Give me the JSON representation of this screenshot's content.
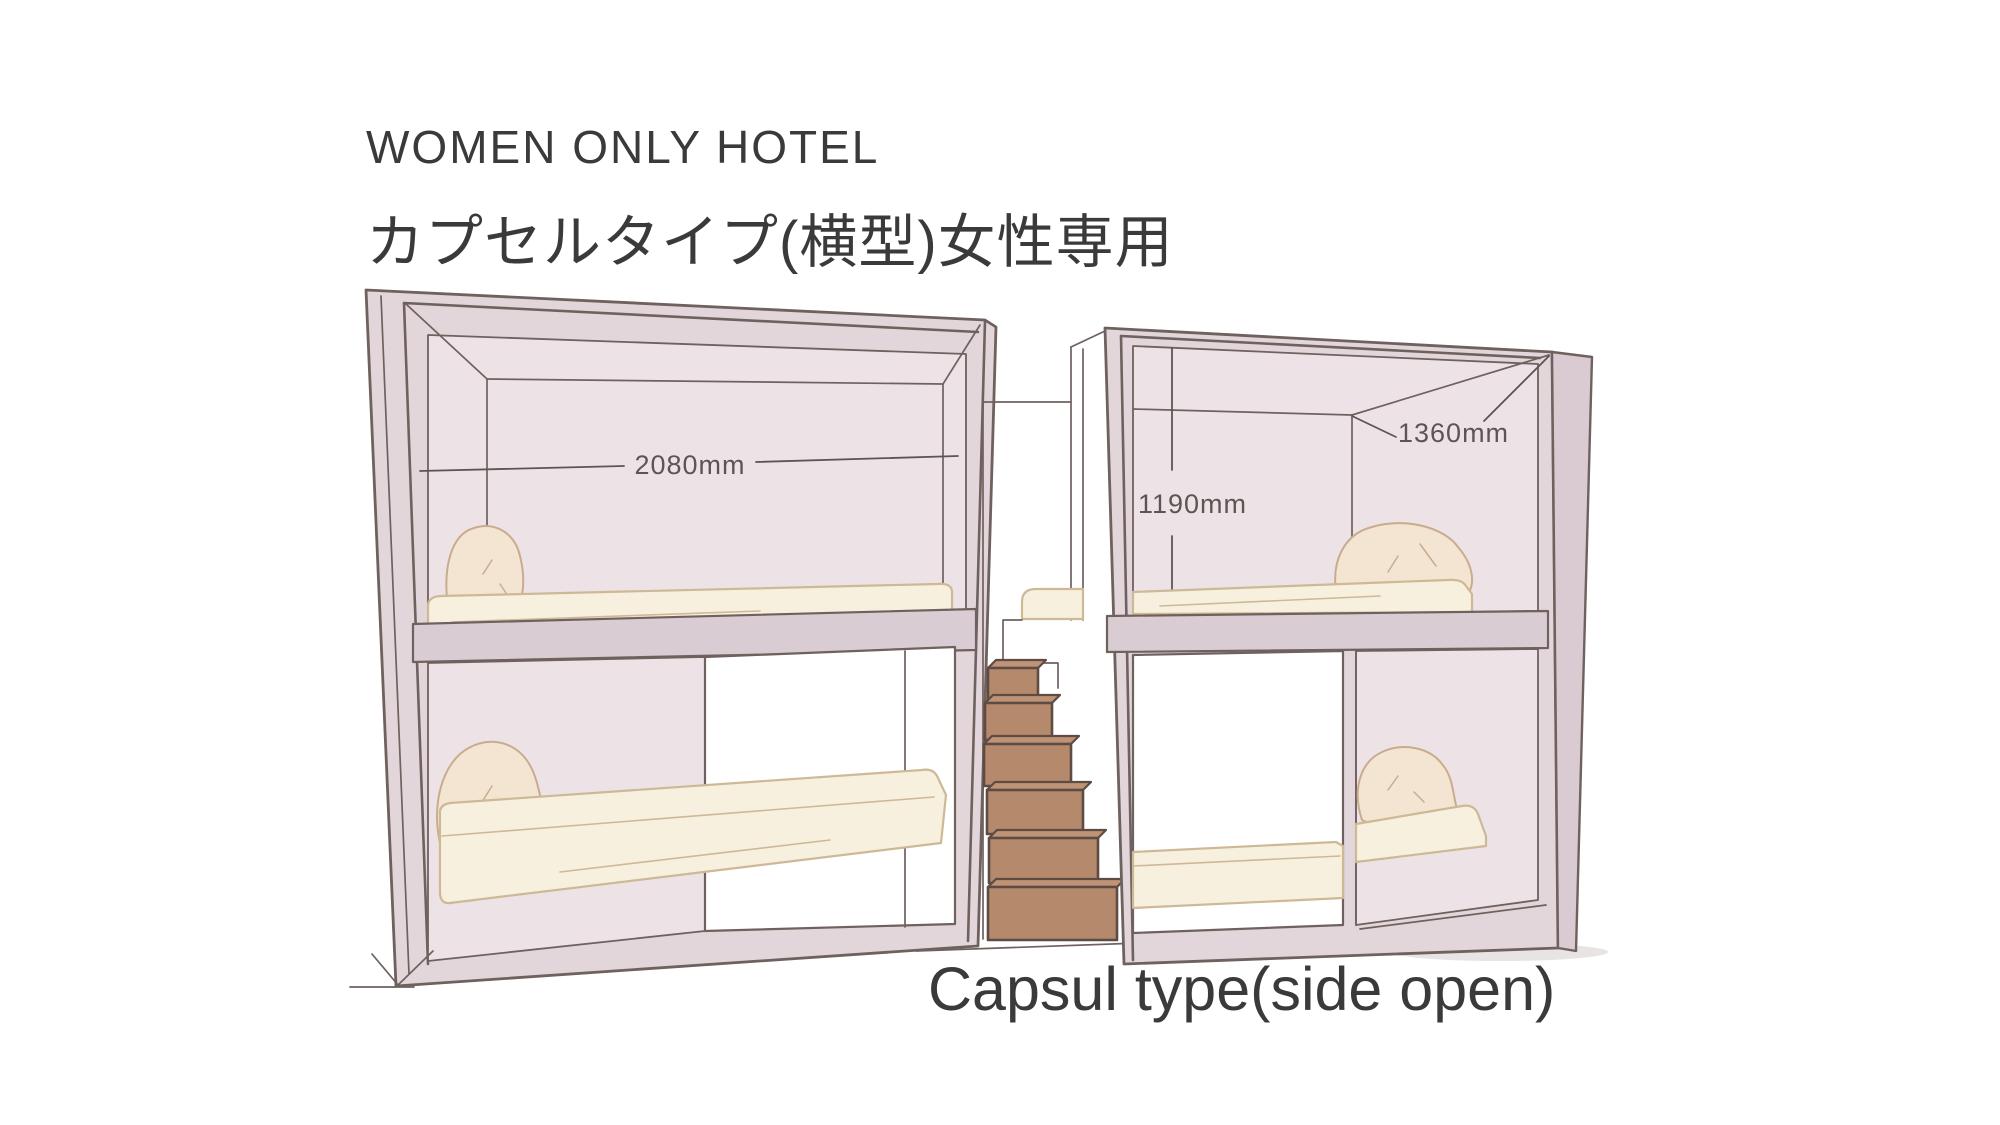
{
  "header": {
    "title": "WOMEN ONLY HOTEL",
    "subtitle": "カプセルタイプ(横型)女性専用"
  },
  "caption": "Capsul type(side open)",
  "dimensions": {
    "width": "2080mm",
    "height": "1190mm",
    "depth": "1360mm"
  },
  "palette": {
    "background": "#ffffff",
    "outline": "#6e615e",
    "frame": "#e3d6db",
    "frame_shade": "#d9cbd1",
    "wall": "#ede3e7",
    "shelf": "#d9cdd3",
    "mattress": "#f8f0de",
    "mattress_edge": "#cdb996",
    "pillow": "#f3e5d2",
    "pillow_edge": "#c9ac8e",
    "stair": "#b5896b",
    "stair_top": "#bf9376",
    "stair_outline": "#5d4b44",
    "text": "#3a3a3a",
    "dimension_text": "#5b5553",
    "shadow": "#d5cecc"
  }
}
